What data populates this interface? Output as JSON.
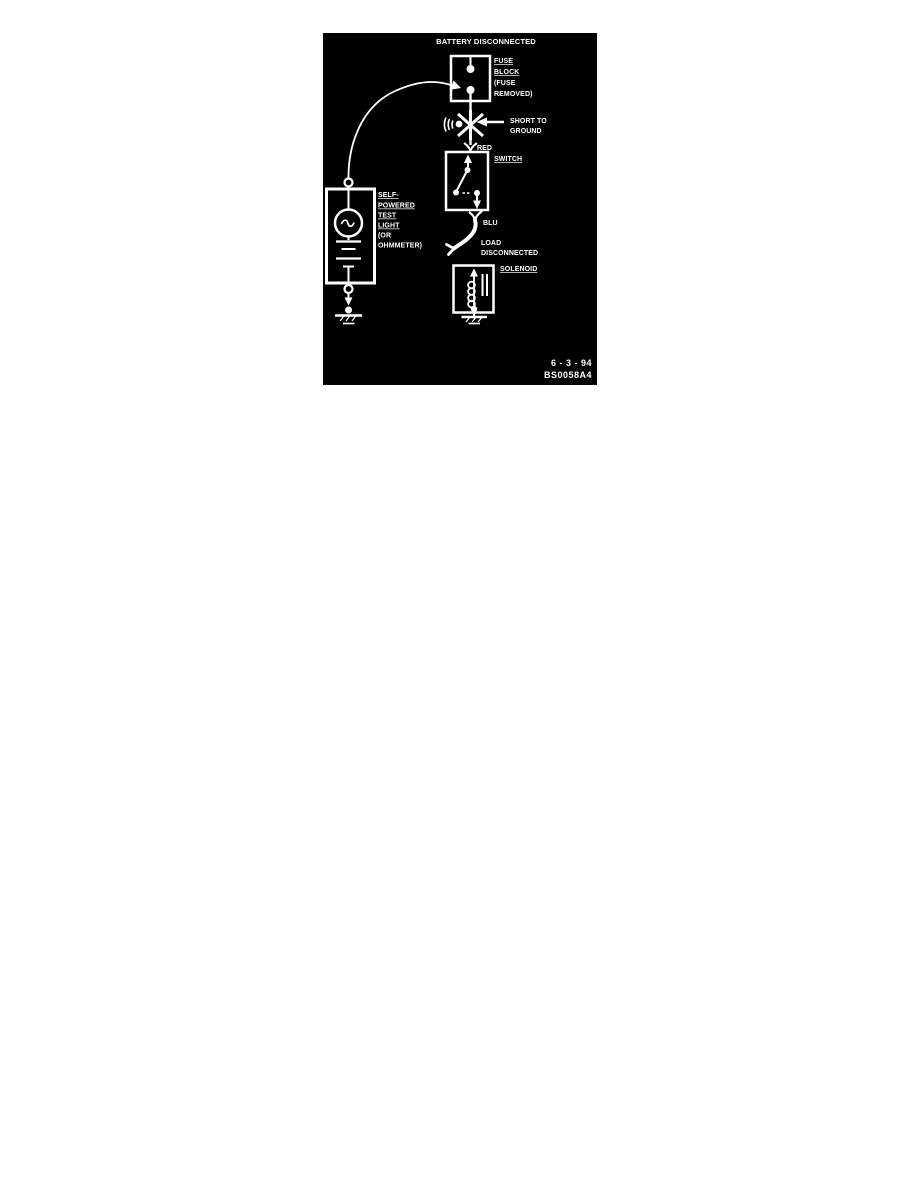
{
  "colors": {
    "page_background": "#ffffff",
    "figure_background": "#000000",
    "ink": "#ffffff"
  },
  "figure": {
    "title": "BATTERY DISCONNECTED",
    "fuse_block_label": [
      "FUSE",
      "BLOCK",
      "(FUSE",
      "REMOVED)"
    ],
    "short_to_ground_label": [
      "SHORT TO",
      "GROUND"
    ],
    "red_wire_label": "RED",
    "switch_label": "SWITCH",
    "blu_wire_label": "BLU",
    "load_disconnected_label": [
      "LOAD",
      "DISCONNECTED"
    ],
    "solenoid_label": "SOLENOID",
    "test_light_label": [
      "SELF-",
      "POWERED",
      "TEST",
      "LIGHT",
      "(OR",
      "OHMMETER)"
    ],
    "date_stamp": "6 - 3 - 94",
    "figure_code": "BS0058A4"
  }
}
